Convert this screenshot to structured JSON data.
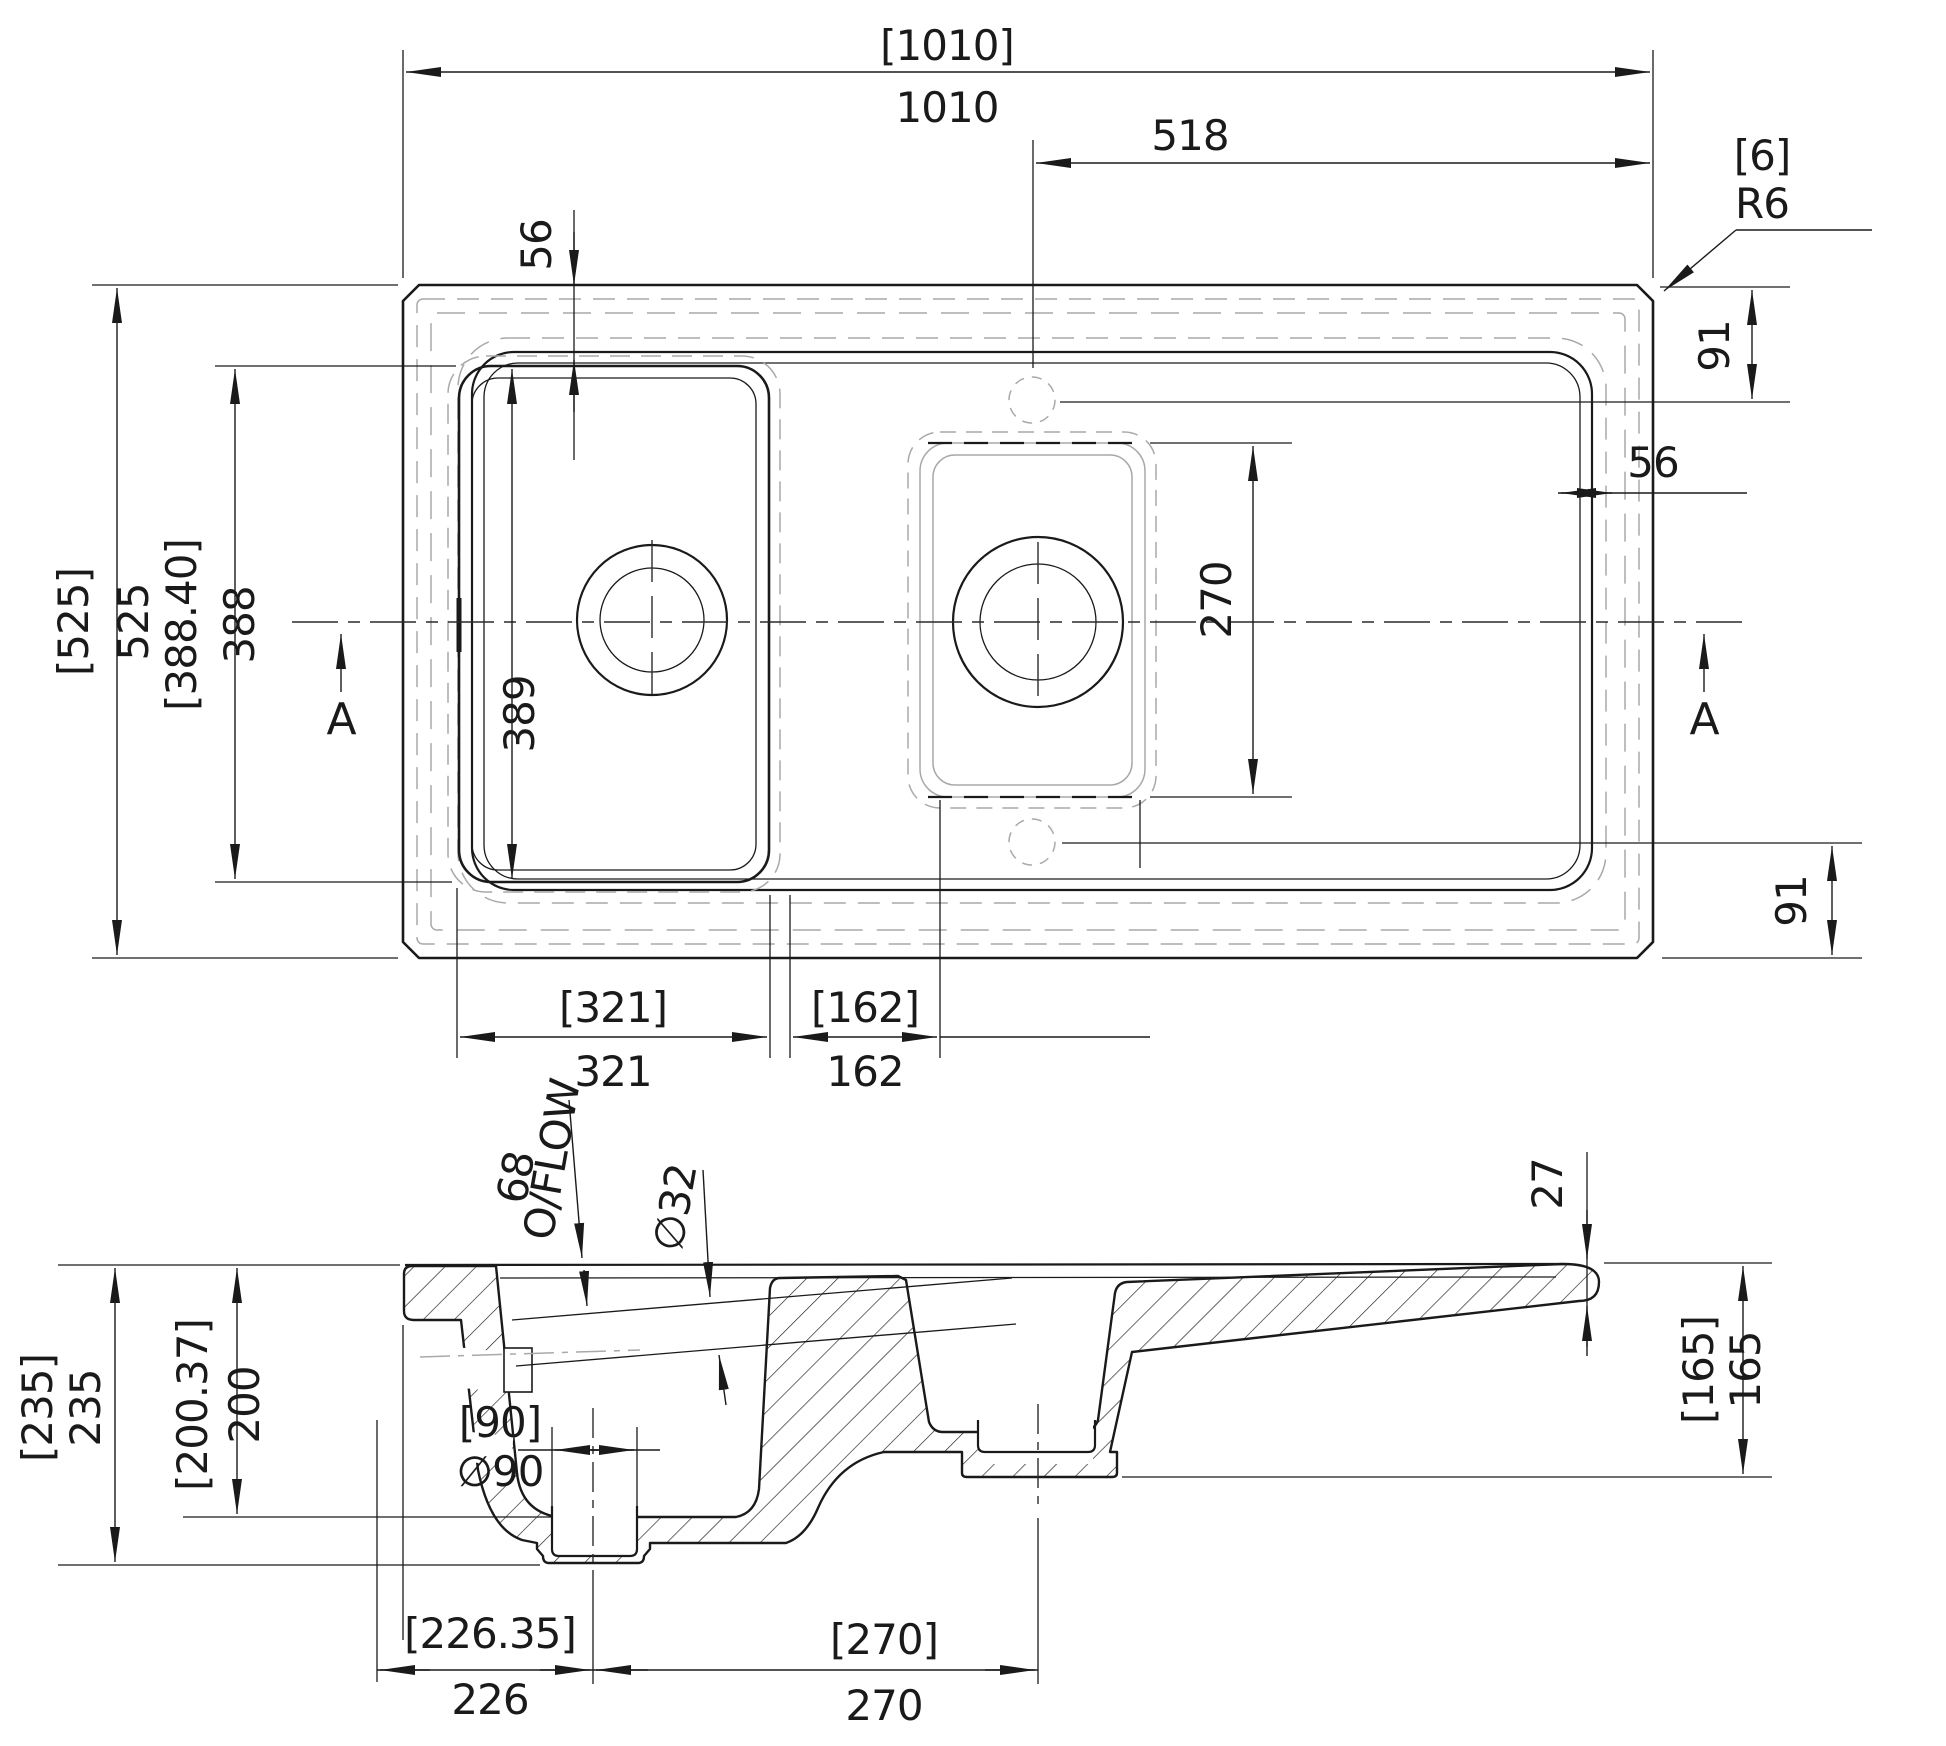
{
  "colors": {
    "line": "#1a1a1a",
    "hidden": "#a9a9a9",
    "background": "#ffffff"
  },
  "plan": {
    "overall_width_bracket": "[1010]",
    "overall_width": "1010",
    "tap_centre_to_edge": "518",
    "corner_chamfer_bracket": "[6]",
    "corner_radius": "R6",
    "rim_inset_top": "56",
    "rim_inset_right": "56",
    "drainer_margin_top": "91",
    "drainer_margin_bottom": "91",
    "overall_depth_bracket": "[525]",
    "overall_depth": "525",
    "cutout_depth_bracket": "[388.40]",
    "cutout_depth": "388",
    "bowl_inner_depth": "389",
    "half_bowl_length": "270",
    "main_bowl_width_bracket": "[321]",
    "main_bowl_width": "321",
    "half_bowl_width_bracket": "[162]",
    "half_bowl_width": "162",
    "section_marker_left": "A",
    "section_marker_right": "A"
  },
  "section": {
    "overflow_depth": "68",
    "overflow_label": "O/FLOW",
    "overflow_diameter": "∅32",
    "drainer_thickness": "27",
    "overall_height_bracket": "[235]",
    "overall_height": "235",
    "bowl_depth_bracket": "[200.37]",
    "bowl_depth": "200",
    "half_bowl_depth_bracket": "[165]",
    "half_bowl_depth": "165",
    "waste_hole_bracket": "[90]",
    "waste_hole_diameter": "∅90",
    "waste_offset_bracket": "[226.35]",
    "waste_offset": "226",
    "bowl_centres_bracket": "[270]",
    "bowl_centres": "270"
  }
}
